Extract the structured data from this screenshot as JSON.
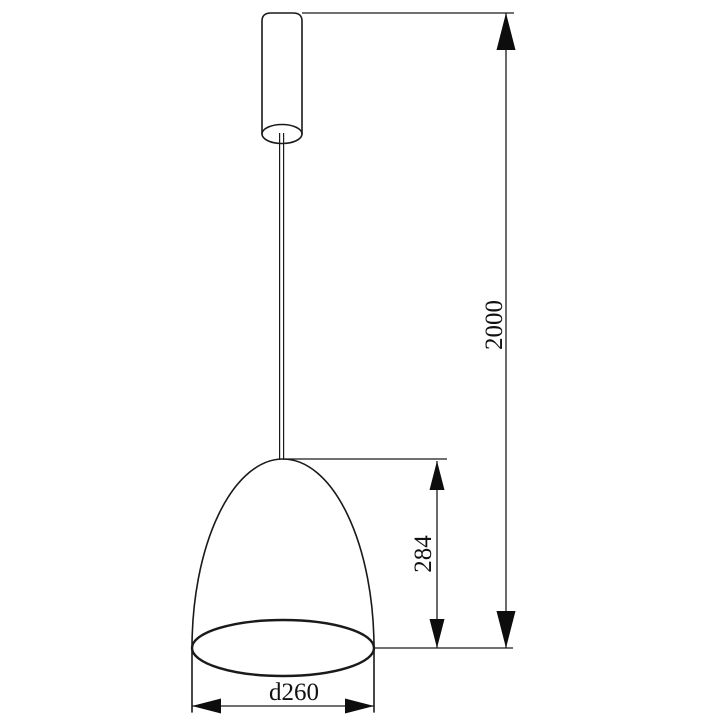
{
  "drawing": {
    "background_color": "#ffffff",
    "line_color": "#1a1a1a",
    "text_color": "#111111",
    "dimensions": {
      "suspension_height": "2000",
      "shade_height": "284",
      "shade_diameter": "d260"
    }
  }
}
